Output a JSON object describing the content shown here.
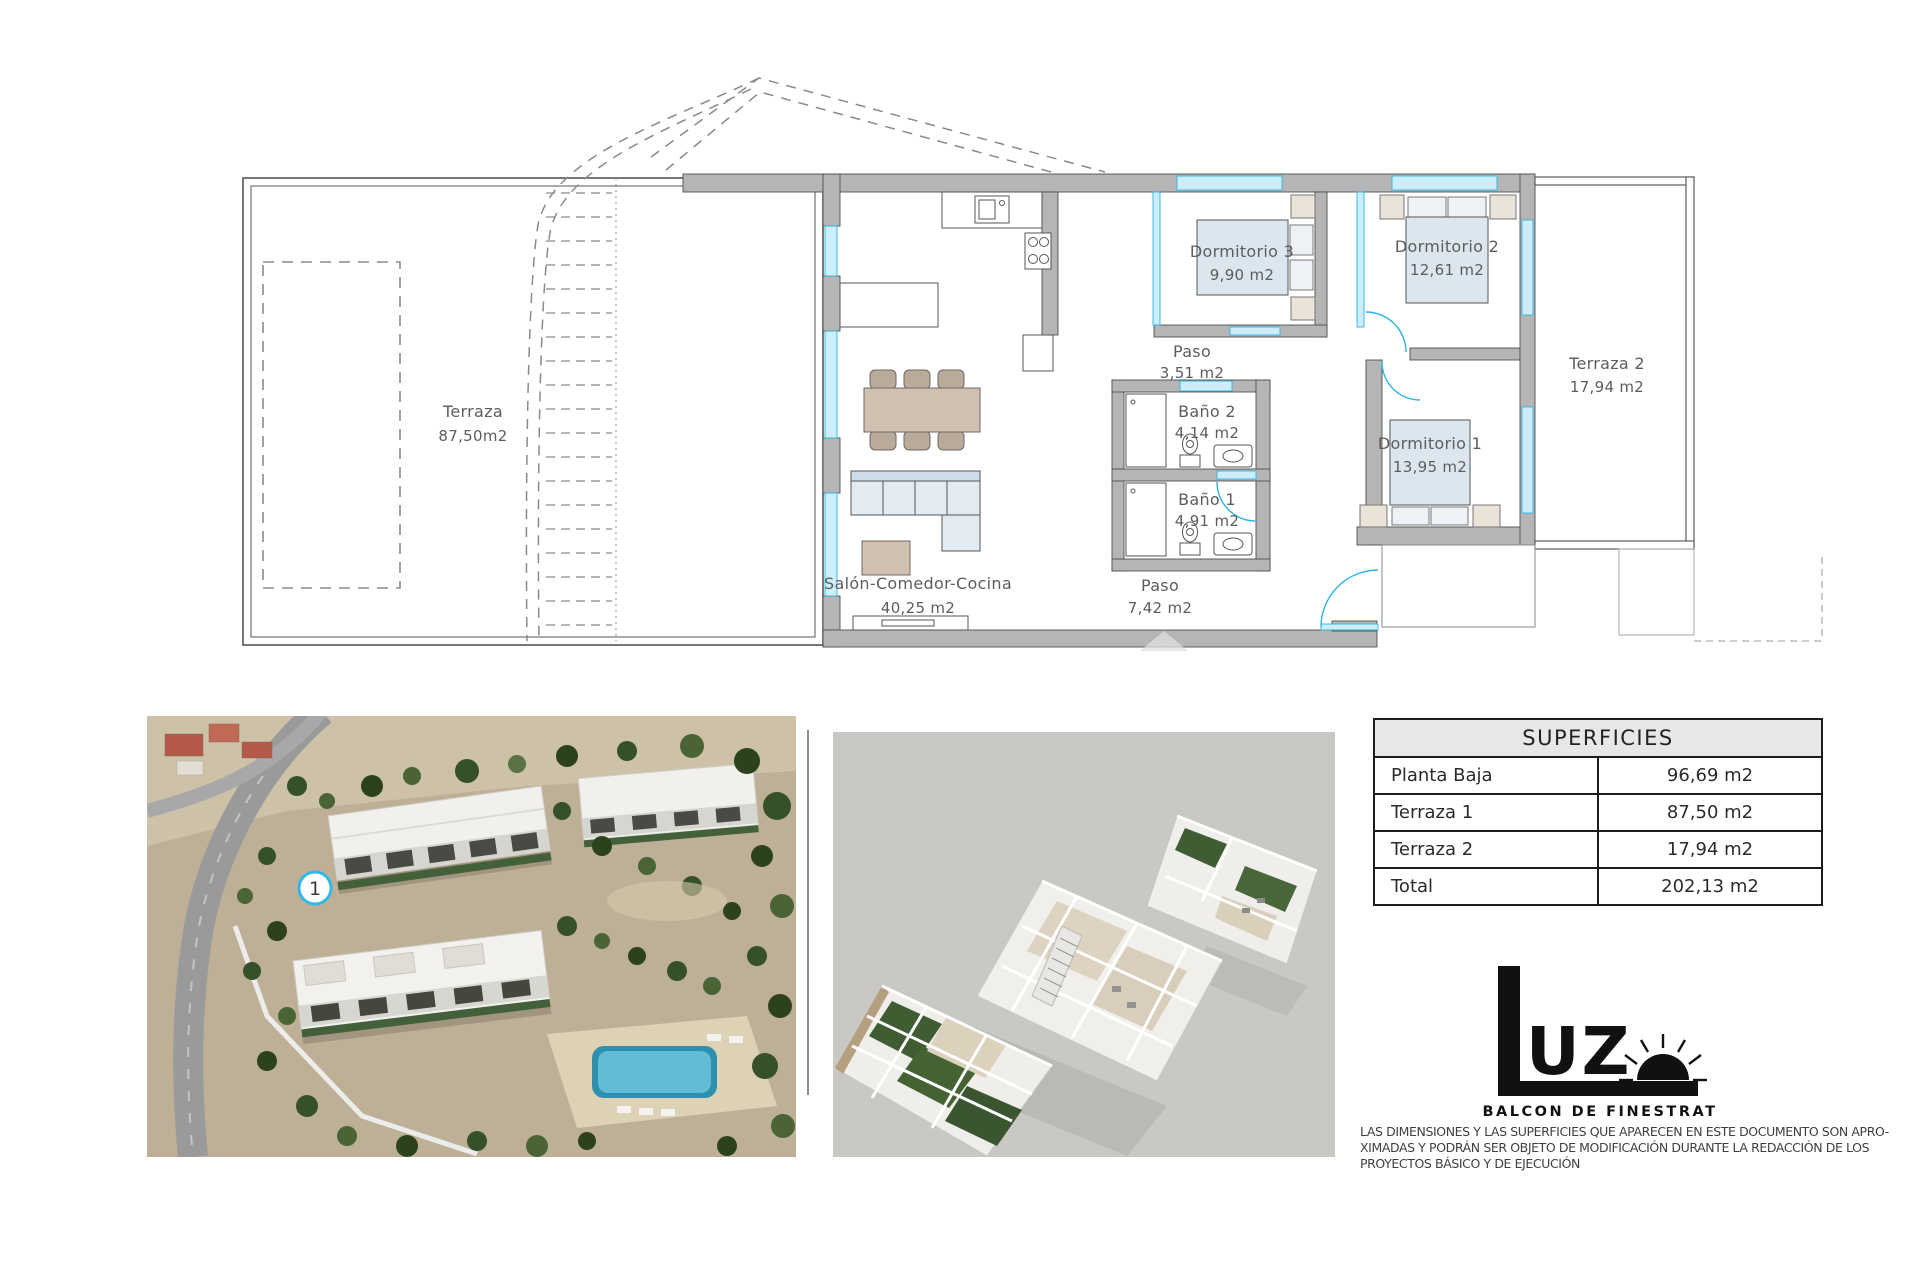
{
  "floorplan": {
    "rooms": {
      "terraza1": {
        "name": "Terraza",
        "area": "87,50m2"
      },
      "salon": {
        "name": "Salón-Comedor-Cocina",
        "area": "40,25 m2"
      },
      "paso1": {
        "name": "Paso",
        "area": "3,51 m2"
      },
      "bano2": {
        "name": "Baño 2",
        "area": "4,14 m2"
      },
      "bano1": {
        "name": "Baño 1",
        "area": "4,91 m2"
      },
      "paso2": {
        "name": "Paso",
        "area": "7,42 m2"
      },
      "dormitorio1": {
        "name": "Dormitorio 1",
        "area": "13,95 m2"
      },
      "dormitorio2": {
        "name": "Dormitorio 2",
        "area": "12,61 m2"
      },
      "dormitorio3": {
        "name": "Dormitorio 3",
        "area": "9,90 m2"
      },
      "terraza2": {
        "name": "Terraza 2",
        "area": "17,94 m2"
      }
    }
  },
  "site_render": {
    "unit_badge": "1"
  },
  "surfaces_table": {
    "title": "SUPERFICIES",
    "rows": [
      {
        "label": "Planta Baja",
        "value": "96,69 m2"
      },
      {
        "label": "Terraza 1",
        "value": "87,50 m2"
      },
      {
        "label": "Terraza 2",
        "value": "17,94 m2"
      },
      {
        "label": "Total",
        "value": "202,13 m2"
      }
    ]
  },
  "logo": {
    "brand_rest": "UZ",
    "subtitle": "BALCON DE FINESTRAT"
  },
  "disclaimer": {
    "lines": [
      "LAS DIMENSIONES Y LAS SUPERFICIES QUE APARECEN EN ESTE DOCUMENTO SON APRO-",
      "XIMADAS Y PODRÁN SER OBJETO DE MODIFICACIÓN DURANTE LA REDACCIÓN DE LOS",
      "PROYECTOS BÁSICO Y DE EJECUCIÓN"
    ]
  },
  "colors": {
    "accent_cyan": "#45C8F1",
    "wall_gray": "#B5B5B5",
    "glazing_fill": "#CDEEF9",
    "bed_fill": "#DBE6EE",
    "furniture_tan": "#CFC0B2",
    "table_border": "#1C1C1C"
  }
}
